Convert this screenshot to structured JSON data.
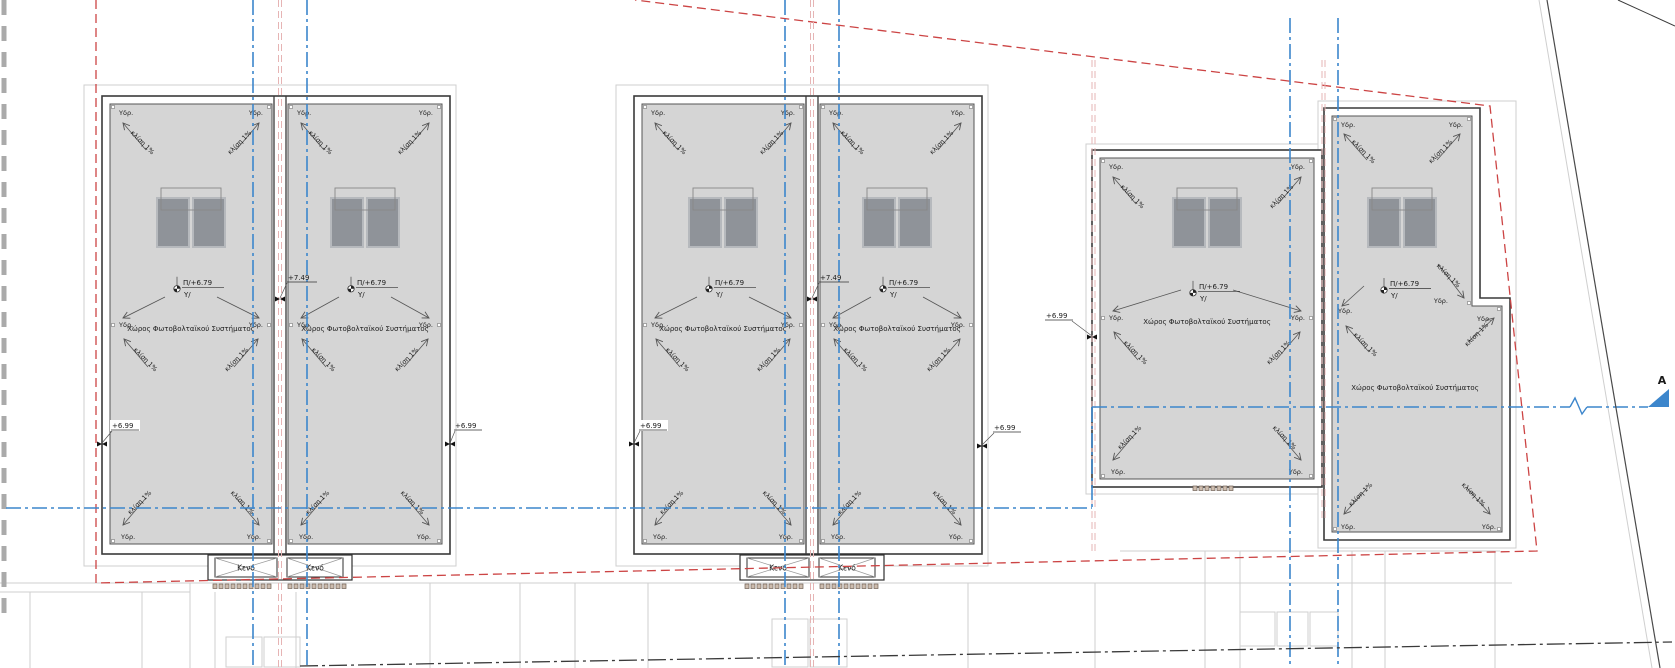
{
  "drawing": {
    "type": "architectural-roof-plan",
    "labels": {
      "pv_space": "Χώρος Φωτοβολταϊκού Συστήματος",
      "slope": "κλίση 1%",
      "drain": "Υδρ.",
      "void": "Κενό",
      "section_letter": "A"
    },
    "elevations": {
      "roof_level": "Π/+6.79",
      "roof_level_sub": "Υ/",
      "parapet_level": "+7.49",
      "slab_level": "+6.99"
    },
    "colors": {
      "roof_fill": "#d5d5d5",
      "band_fill": "#ffffff",
      "line_dark": "#3a3a3a",
      "roof_edge": "#555555",
      "panel_fill": "#8f9399",
      "panel_border": "#b6b9bd",
      "panel_frame": "#888888",
      "blue_axis": "#3c86cc",
      "red_boundary": "#cc4444",
      "pink_axis": "#e6b4b4",
      "light_gray": "#cfcfcf",
      "road_dark": "#3a3a3a",
      "hatch_fill": "#cdbcae",
      "hatch_edge": "#6f6054",
      "text": "#1a1a1a"
    },
    "geometry": {
      "canvas": {
        "w": 1675,
        "h": 668
      },
      "buildings": [
        {
          "id": "B1",
          "outer": [
            102,
            96,
            348,
            458
          ],
          "divider_cx": 280,
          "roofs": [
            {
              "id": "R1",
              "rect": [
                110,
                104,
                162,
                440
              ],
              "midY": 325
            },
            {
              "id": "R2",
              "rect": [
                288,
                104,
                154,
                440
              ],
              "midY": 325
            }
          ]
        },
        {
          "id": "B2",
          "outer": [
            634,
            96,
            348,
            458
          ],
          "divider_cx": 812,
          "roofs": [
            {
              "id": "R3",
              "rect": [
                642,
                104,
                162,
                440
              ],
              "midY": 325
            },
            {
              "id": "R4",
              "rect": [
                820,
                104,
                154,
                440
              ],
              "midY": 325
            }
          ]
        },
        {
          "id": "B3",
          "outer": [
            1092,
            150,
            230,
            337
          ],
          "roofs": [
            {
              "id": "R5",
              "rect": [
                1100,
                158,
                214,
                321
              ],
              "midY": 318
            }
          ]
        },
        {
          "id": "B4",
          "outer_poly": [
            [
              1324,
              108
            ],
            [
              1480,
              108
            ],
            [
              1480,
              298
            ],
            [
              1510,
              298
            ],
            [
              1510,
              540
            ],
            [
              1324,
              540
            ]
          ],
          "roofs": [
            {
              "id": "R6",
              "poly": [
                [
                  1332,
                  116
                ],
                [
                  1472,
                  116
                ],
                [
                  1472,
                  306
                ],
                [
                  1502,
                  306
                ],
                [
                  1502,
                  532
                ],
                [
                  1332,
                  532
                ]
              ],
              "custom": true
            }
          ]
        }
      ],
      "panel_groups": [
        191,
        365,
        723,
        897,
        1207,
        1402
      ],
      "voids": [
        {
          "cx": 280,
          "y": 555
        },
        {
          "cx": 812,
          "y": 555
        }
      ],
      "hatch_strips": [
        {
          "x1": 213,
          "x2": 273,
          "y": 584
        },
        {
          "x1": 288,
          "x2": 348,
          "y": 584
        },
        {
          "x1": 745,
          "x2": 805,
          "y": 584
        },
        {
          "x1": 820,
          "x2": 880,
          "y": 584
        },
        {
          "x1": 1193,
          "x2": 1237,
          "y": 486
        }
      ],
      "markers_699": [
        {
          "x": 112,
          "y": 428,
          "mx": 102,
          "my": 444,
          "bg": true
        },
        {
          "x": 455,
          "y": 428,
          "mx": 450,
          "my": 444,
          "bg": false
        },
        {
          "x": 640,
          "y": 428,
          "mx": 634,
          "my": 444,
          "bg": true
        },
        {
          "x": 994,
          "y": 430,
          "mx": 982,
          "my": 446,
          "bg": false
        },
        {
          "x": 1046,
          "y": 318,
          "mx": 1092,
          "my": 337,
          "bg": false
        }
      ],
      "markers_749": [
        {
          "x": 288,
          "y": 280,
          "mx": 280,
          "my": 299
        },
        {
          "x": 820,
          "y": 280,
          "mx": 812,
          "my": 299
        }
      ],
      "red_boundary_polyline": [
        [
          96,
          0
        ],
        [
          96,
          583
        ],
        [
          1537,
          551
        ],
        [
          1490,
          106
        ],
        [
          635,
          0
        ]
      ],
      "pink_axes": [
        [
          278.5,
          0,
          668
        ],
        [
          281.5,
          0,
          668
        ],
        [
          810.5,
          0,
          668
        ],
        [
          813.5,
          0,
          668
        ],
        [
          1092,
          60,
          555
        ],
        [
          1095,
          60,
          555
        ],
        [
          1322,
          60,
          520
        ],
        [
          1325,
          60,
          520
        ]
      ],
      "blue_axes_v": [
        [
          253,
          0,
          668
        ],
        [
          307,
          0,
          668
        ],
        [
          785,
          0,
          668
        ],
        [
          839,
          0,
          668
        ],
        [
          1290,
          18,
          668
        ],
        [
          1338,
          18,
          668
        ],
        [
          1092,
          407,
          508
        ]
      ],
      "blue_axes_h": [
        [
          6,
          508,
          1092,
          508
        ],
        [
          1092,
          407,
          1570,
          407
        ],
        [
          1587,
          407,
          1648,
          407
        ]
      ],
      "section_squiggle": [
        [
          1570,
          407
        ],
        [
          1575,
          398
        ],
        [
          1582,
          414
        ],
        [
          1587,
          407
        ]
      ],
      "section_marker": {
        "triangle": [
          [
            1648,
            407
          ],
          [
            1669,
            407
          ],
          [
            1669,
            389
          ]
        ],
        "label_x": 1662,
        "label_y": 384
      },
      "surround_rects": [
        [
          84,
          85,
          372,
          481
        ],
        [
          616,
          85,
          372,
          481
        ],
        [
          1086,
          144,
          232,
          350
        ],
        [
          1318,
          101,
          198,
          447
        ]
      ],
      "light_segments": [
        [
          0,
          583,
          1512,
          583
        ],
        [
          0,
          592,
          190,
          592
        ],
        [
          190,
          583,
          190,
          668
        ],
        [
          30,
          592,
          30,
          668
        ],
        [
          142,
          592,
          142,
          668
        ],
        [
          215,
          592,
          215,
          668
        ],
        [
          296,
          592,
          296,
          668
        ],
        [
          430,
          583,
          430,
          668
        ],
        [
          520,
          583,
          520,
          668
        ],
        [
          575,
          583,
          575,
          668
        ],
        [
          648,
          583,
          648,
          668
        ],
        [
          968,
          583,
          968,
          668
        ],
        [
          1095,
          583,
          1095,
          668
        ],
        [
          1205,
          551,
          1205,
          668
        ],
        [
          1240,
          551,
          1240,
          668
        ],
        [
          1352,
          551,
          1352,
          668
        ],
        [
          1385,
          551,
          1385,
          668
        ],
        [
          1495,
          551,
          1495,
          668
        ],
        [
          1120,
          551,
          1500,
          551
        ]
      ],
      "light_boxes": [
        [
          226,
          637,
          36,
          30
        ],
        [
          264,
          637,
          36,
          30
        ],
        [
          772,
          619,
          36,
          48
        ],
        [
          810,
          619,
          37,
          48
        ],
        [
          1240,
          612,
          35,
          34
        ],
        [
          1277,
          612,
          31,
          34
        ],
        [
          1310,
          612,
          28,
          34
        ]
      ],
      "road_line": [
        300,
        666,
        1672,
        642
      ],
      "corner_segment": [
        1618,
        0,
        1675,
        26
      ],
      "right_boundary_dark": [
        1547,
        0,
        1660,
        668
      ],
      "right_boundary_light": [
        1539,
        0,
        1652,
        668
      ],
      "gray_bar": {
        "x": 4,
        "y1": 0,
        "y2": 620
      }
    }
  }
}
